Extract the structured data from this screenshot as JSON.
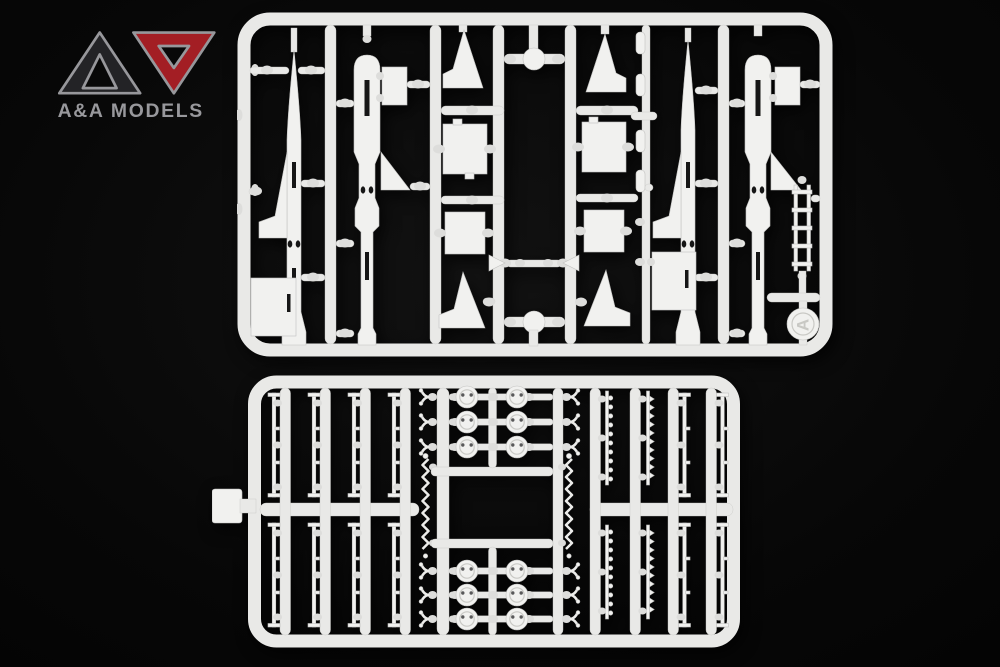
{
  "meta": {
    "scene": "Studio product photo of two white injection-molded styrene sprues (plastic model kit part frames) with missile parts, lit against a black background",
    "background_color": "#070707"
  },
  "logo": {
    "brand": "A&A MODELS",
    "mark_left_color": "#232326",
    "mark_right_color": "#a31e24",
    "outline_color": "#97979b",
    "text_color": "#98989c"
  },
  "sprues": {
    "plastic_color": "#e9e9e7",
    "top": {
      "gate_label": "A",
      "description": "Main sprue A with missile fuselage halves, nose cones, fins and boxes",
      "parts": [
        "missile fuselage half with pointed nose cone (×2)",
        "rocket motor section half with boat-tail (×2)",
        "large swept fin (×2)",
        "clipped delta fin (×2)",
        "wedge fin (×2)",
        "equipment box (×4)",
        "flat rectangular panel (×4)",
        "round disc on cross runner (×2)",
        "launch-rail ladder (×1)",
        "small winged unit (×1)",
        "small cylindrical fittings (×4)"
      ]
    },
    "bottom": {
      "description": "Detail sprue with thin rods, perforated wheel discs, clevis forks and racks",
      "parts": [
        "thin antenna rod with end bars (×8)",
        "perforated wheel disc (×12)",
        "clevis fork (×12)",
        "zigzag coil strip (×2)",
        "beaded rod (×4)",
        "notched rack strip (×4)",
        "plain thin rod (×4)"
      ]
    }
  }
}
